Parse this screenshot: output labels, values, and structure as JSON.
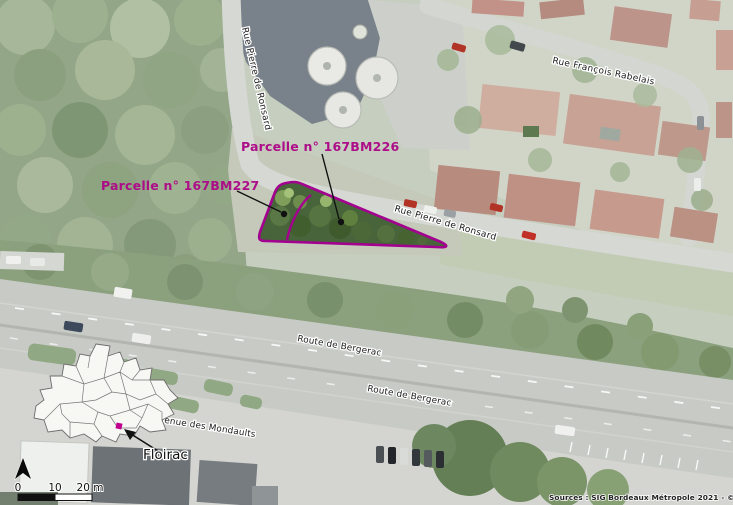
{
  "map": {
    "title": "Plan de situation des parcelles 167BM226 et 167BM227 - Floirac",
    "parcels": [
      {
        "id": "167BM226",
        "label": "Parcelle n° 167BM226"
      },
      {
        "id": "167BM227",
        "label": "Parcelle n° 167BM227"
      }
    ],
    "streets": {
      "ronsard_top": "Rue Pierre de Ronsard",
      "ronsard_east": "Rue Pierre de Ronsard",
      "rabelais": "Rue François Rabelais",
      "bergerac_upper": "Route de Bergerac",
      "bergerac_lower": "Route de Bergerac",
      "mondaults": "Avenue des Mondaults"
    },
    "inset": {
      "commune": "Floirac"
    },
    "scalebar": {
      "tick_0": "0",
      "tick_10": "10",
      "tick_20": "20 m"
    },
    "credits": "Sources : SIG Bordeaux Métropole 2021 - © BxMetro 2020.",
    "colors": {
      "parcel_outline": "#a4008f",
      "parcel_label": "#ad0d88",
      "location_marker": "#c0008c",
      "parcel_fill": "#47643a"
    }
  }
}
